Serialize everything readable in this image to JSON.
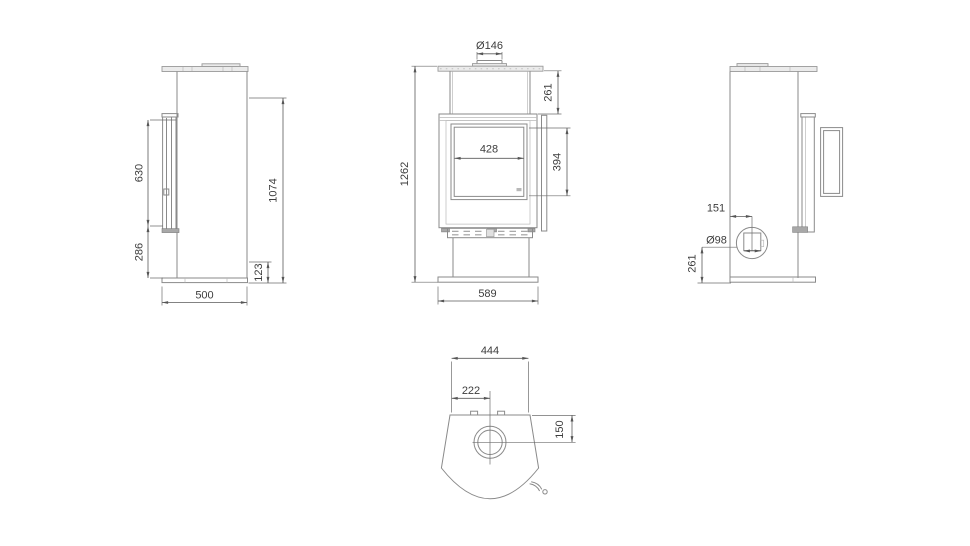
{
  "drawing": {
    "type": "technical-orthographic-views",
    "subject": "free-standing stove dimensional drawing",
    "colors": {
      "background": "#ffffff",
      "geometry_line": "#8a8a8a",
      "dimension_line": "#5a5a5a",
      "text": "#3d3d3d",
      "plate_fill": "#ebebeb",
      "dark_fill": "#a8a8a8"
    },
    "views": {
      "left_side": {
        "label": "left side view",
        "dims": {
          "door_glass_height": "630",
          "lower_section_height": "286",
          "upper_reference_height": "1074",
          "base_height": "123",
          "depth": "500"
        }
      },
      "front": {
        "label": "front view",
        "dims": {
          "flue_diameter": "Ø146",
          "top_section_height": "261",
          "glass_width": "428",
          "glass_height": "394",
          "total_height": "1262",
          "width": "589"
        }
      },
      "right_side": {
        "label": "right side view",
        "dims": {
          "inlet_offset_from_back": "151",
          "air_inlet_diameter": "Ø98",
          "inlet_axis_height": "261"
        }
      },
      "top": {
        "label": "top view",
        "dims": {
          "body_back_width": "444",
          "flue_center_offset": "222",
          "flue_center_from_back": "150"
        }
      }
    }
  }
}
